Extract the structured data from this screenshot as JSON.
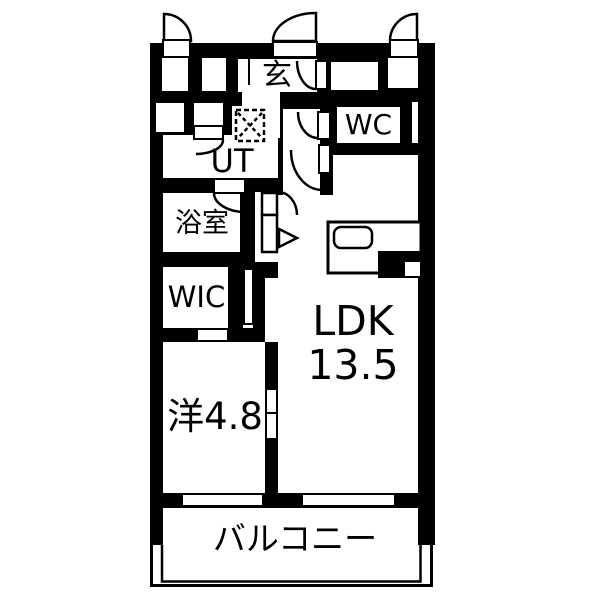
{
  "title": "apartment-floor-plan",
  "colors": {
    "wall": "#000000",
    "floor": "#ffffff",
    "line": "#000000"
  },
  "rooms": {
    "genkan": {
      "label": "玄"
    },
    "wc": {
      "label": "WC"
    },
    "ut": {
      "label": "UT"
    },
    "bathroom": {
      "label": "浴室"
    },
    "wic": {
      "label": "WIC"
    },
    "ldk": {
      "label": "LDK",
      "size": "13.5"
    },
    "western_room": {
      "label": "洋4.8"
    },
    "balcony": {
      "label": "バルコニー"
    }
  },
  "fixtures": {
    "washing_machine": "washing-machine-pan",
    "kitchen_counter": "kitchen-counter",
    "sink": "kitchen-sink",
    "stove": "stove",
    "doors": "swing-door-arcs",
    "windows": "bottom-wall-windows",
    "direction_arrow": "right-triangle-marker"
  }
}
